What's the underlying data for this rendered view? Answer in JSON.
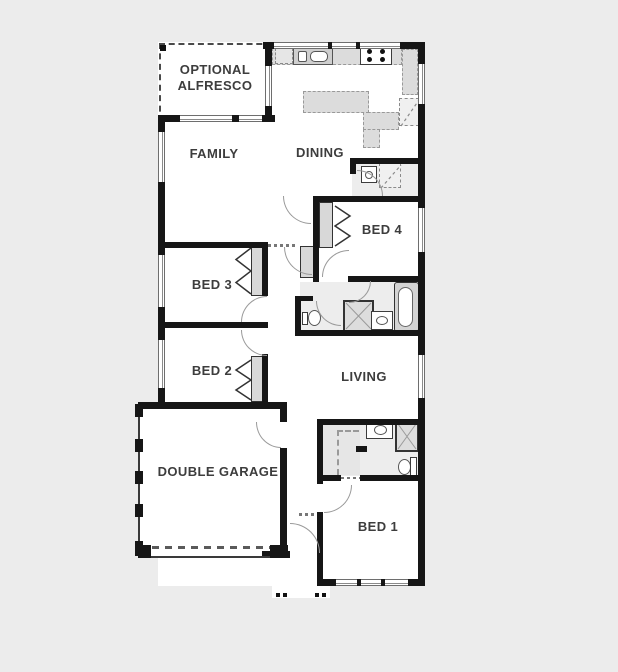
{
  "plan_title": "single-storey house floor plan",
  "rooms": [
    {
      "name": "optional-alfresco",
      "line1": "OPTIONAL",
      "line2": "ALFRESCO"
    },
    {
      "name": "family",
      "label": "FAMILY"
    },
    {
      "name": "dining",
      "label": "DINING"
    },
    {
      "name": "bed4",
      "label": "BED 4"
    },
    {
      "name": "bed3",
      "label": "BED 3"
    },
    {
      "name": "bed2",
      "label": "BED 2"
    },
    {
      "name": "living",
      "label": "LIVING"
    },
    {
      "name": "double-garage",
      "label": "DOUBLE GARAGE"
    },
    {
      "name": "bed1",
      "label": "BED 1"
    }
  ],
  "fixtures": [
    "kitchen-sink",
    "cooktop",
    "dishwasher",
    "fridge-space",
    "island-bench",
    "corner-pantry",
    "laundry-tub",
    "linen-cupboard",
    "bathtub",
    "shower",
    "vanity-basin",
    "toilet",
    "wardrobe-chevrons",
    "walk-in-robe",
    "garage-door-line",
    "porch-posts",
    "entry-door"
  ],
  "colors": {
    "background": "#ececec",
    "wall": "#161616",
    "fixture_gray": "#d8d8d8",
    "floor": "#ffffff",
    "floor_wet": "#ededed",
    "text": "#3d3d3d"
  }
}
